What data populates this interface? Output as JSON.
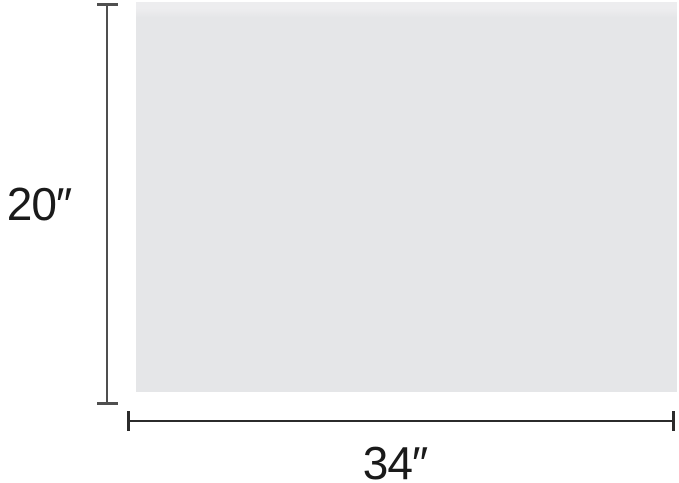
{
  "diagram": {
    "kind": "rectangle-dimension-diagram",
    "dimensions": {
      "height_label": "20″",
      "width_label": "34″"
    }
  },
  "colors": {
    "background": "#ffffff",
    "rectangle_fill": "#e5e6e8",
    "rectangle_fill_top": "#ededef",
    "dimension_line": "#4f4f4f",
    "dimension_line_horizontal": "#2b2b2b",
    "label_text": "#1a1a1a"
  }
}
